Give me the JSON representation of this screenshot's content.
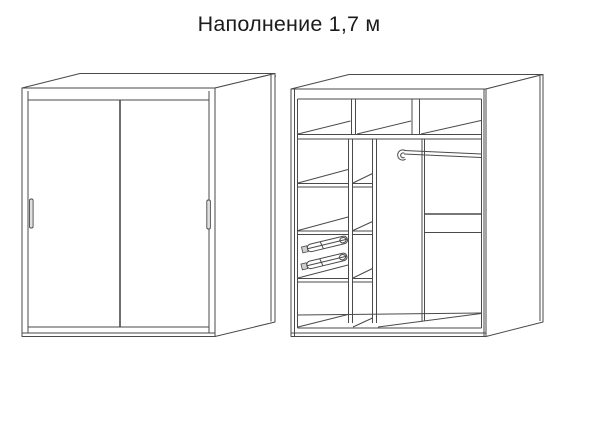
{
  "title": "Наполнение 1,7 м",
  "colors": {
    "background": "#ffffff",
    "line": "#4a4a4a",
    "text": "#1b1b1b",
    "handle_fill": "#e0e0e0"
  }
}
